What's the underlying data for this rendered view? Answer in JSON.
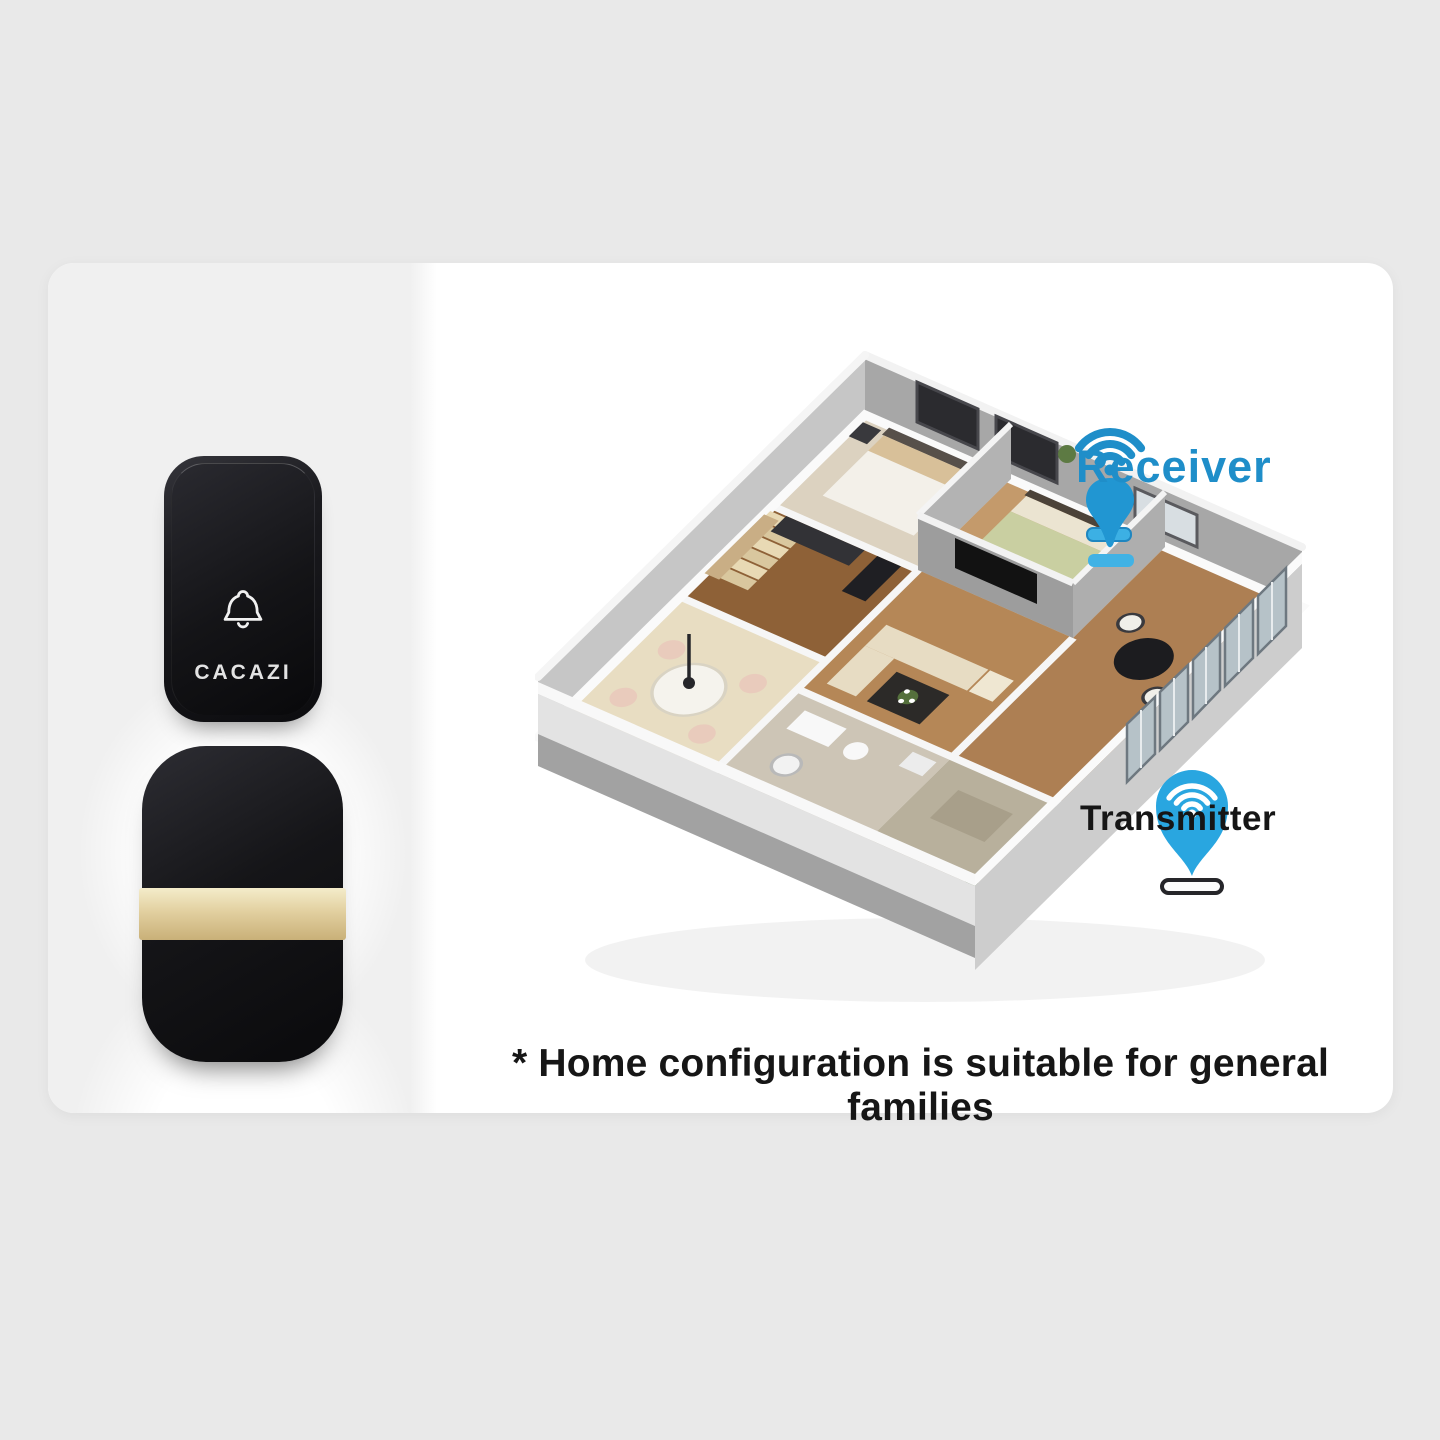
{
  "colors": {
    "page_bg": "#e9e9e9",
    "card_bg": "#ffffff",
    "left_panel_bg": "#f0f0f0",
    "device_black": "#121215",
    "gold_band": "#e2d0a0",
    "accent_blue": "#1f8ec9",
    "pin_blue": "#29a6e0",
    "text_dark": "#161616"
  },
  "products": {
    "transmitter_button": {
      "brand": "CACAZI",
      "icon": "bell-outline-icon"
    },
    "receiver_unit": {
      "band": "gold"
    }
  },
  "floorplan": {
    "receiver_label": "Receiver",
    "transmitter_label": "Transmitter"
  },
  "caption": "* Home configuration is suitable for general families"
}
